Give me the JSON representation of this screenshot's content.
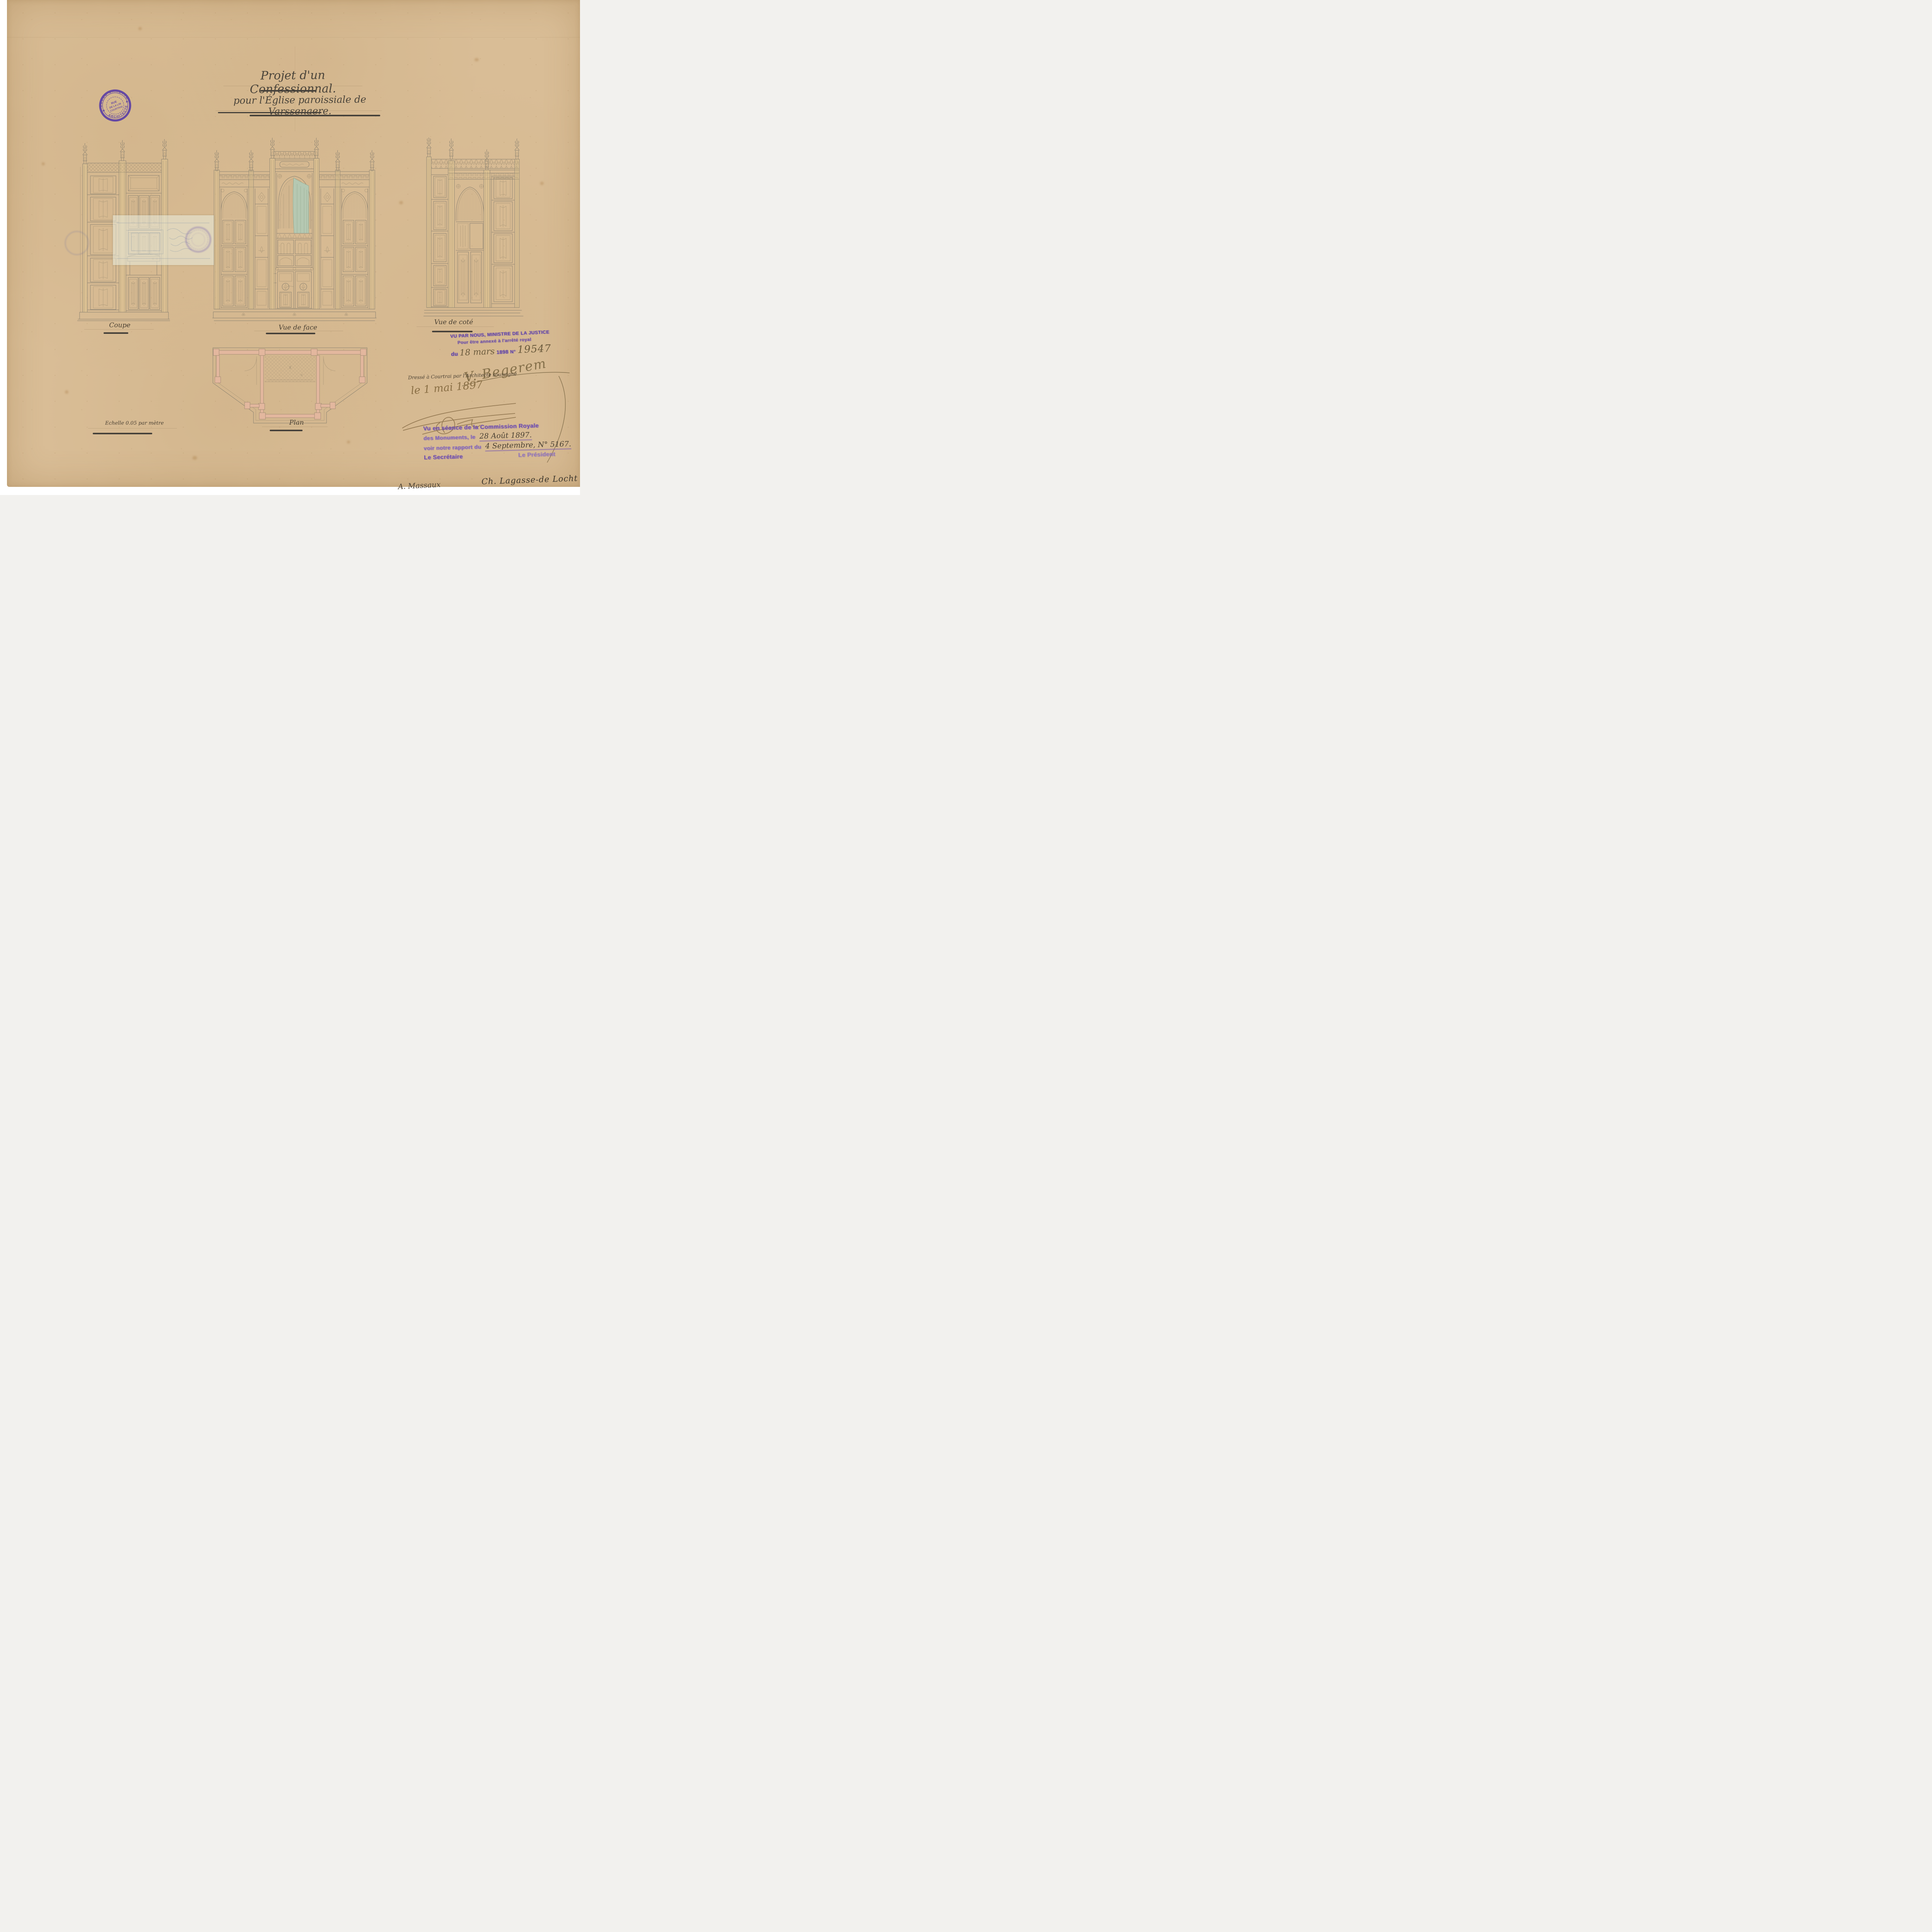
{
  "document": {
    "type": "architectural drawing, ink and pencil on paper, 1897",
    "title_line1": "Projet d'un Confessionnal.",
    "title_line2": "pour l'Église paroissiale de Varssenaere.",
    "scale_note": "Echelle 0.05 par mètre"
  },
  "view_labels": {
    "section": "Coupe",
    "front": "Vue de face",
    "side": "Vue de coté",
    "plan": "Plan"
  },
  "architect_stamp": {
    "name": "JULES CARETTE",
    "profession": "ARCHITECTE",
    "address_line1": "RUE",
    "address_line2": "DE LA LOI",
    "address_line3": "COURTRAI",
    "ink_color": "#5a3ea6"
  },
  "justice_stamp": {
    "line1": "VU PAR NOUS, MINISTRE DE LA JUSTICE",
    "line2": "Pour être annexé à l'arrêté royal",
    "du_label": "du",
    "date_handwritten": "18 mars",
    "year": "1898",
    "number_label": "N°",
    "number_handwritten": "19547",
    "ink_color": "#7452b0"
  },
  "minister_signature": {
    "name": "V. Begerem"
  },
  "drafting_note": {
    "line1": "Dressé à Courtrai par l'Architecte soussigné",
    "date_handwritten": "le 1 mai 1897",
    "signature_name": "J. Carette"
  },
  "commission_stamp": {
    "line1": "Vu en séance de la Commission Royale",
    "line2_label": "des Monuments, le",
    "line2_handwritten": "28 Août 1897.",
    "line3_label": "voir notre rapport du",
    "line3_handwritten": "4 Septembre, N° 5167.",
    "secretary_label": "Le Secrétaire",
    "president_label": "Le Président",
    "ink_color": "#7e5cb8"
  },
  "signatures": {
    "secretary": "A. Massaux",
    "president": "Ch. Lagasse-de Locht"
  },
  "colors": {
    "paper": "#d9bd96",
    "pencil": "#8d8371",
    "stamp_purple": "#5f43a5",
    "ink_brown": "#8a6f45",
    "curtain_green": "#b5c8b2",
    "plan_wall_pink": "#e3b79e"
  }
}
